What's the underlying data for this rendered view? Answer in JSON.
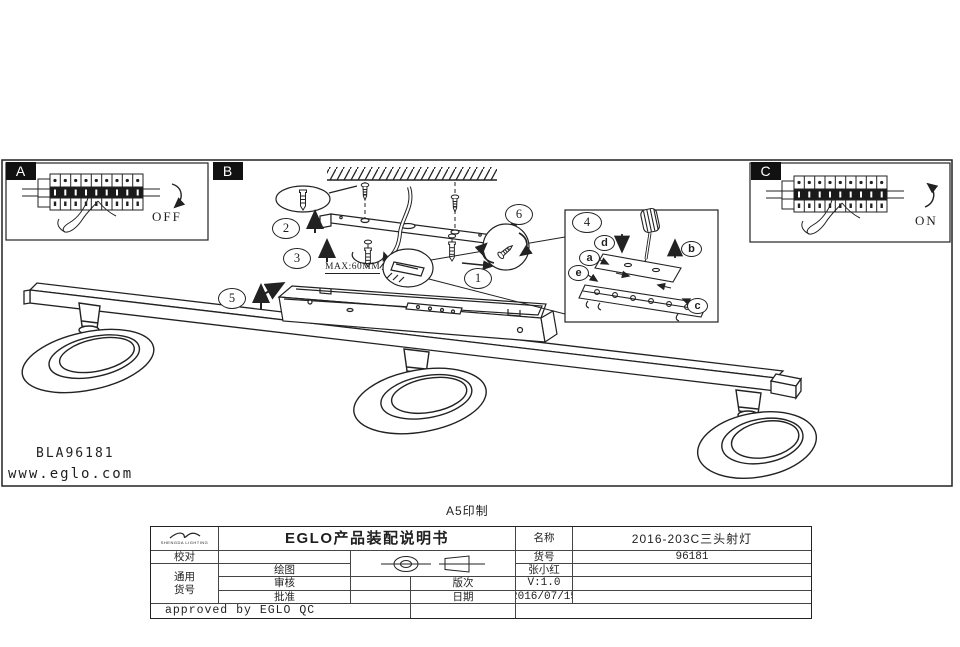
{
  "colors": {
    "ink": "#1f1f1f",
    "paper": "#ffffff"
  },
  "drawing": {
    "panel_a": {
      "label": "A",
      "switch_state": "OFF"
    },
    "panel_b": {
      "label": "B",
      "max_depth": "MAX:60MM",
      "steps": {
        "s1": "1",
        "s2": "2",
        "s3": "3",
        "s5": "5",
        "s6": "6"
      }
    },
    "panel_c": {
      "label": "C",
      "switch_state": "ON"
    },
    "detail_box": {
      "number": "4",
      "parts": {
        "a": "a",
        "b": "b",
        "c": "c",
        "d": "d",
        "e": "e"
      }
    },
    "model_code": "BLA96181",
    "website": "www.eglo.com"
  },
  "footer_note": "A5印制",
  "title_block": {
    "logo_text": "SHENGDA LIGHTING",
    "doc_title": "EGLO产品装配说明书",
    "labels": {
      "proofread": "校对",
      "drafted": "绘图",
      "reviewed": "审核",
      "approved": "批准",
      "version": "版次",
      "date": "日期",
      "name": "名称",
      "item_no": "货号",
      "common_1": "通用",
      "common_2": "货号"
    },
    "values": {
      "drafted_by": "张小红",
      "version": "V:1.0",
      "date": "2016/07/15",
      "name": "2016-203C三头射灯",
      "item_no": "96181",
      "approved_by": "approved by EGLO QC"
    }
  }
}
